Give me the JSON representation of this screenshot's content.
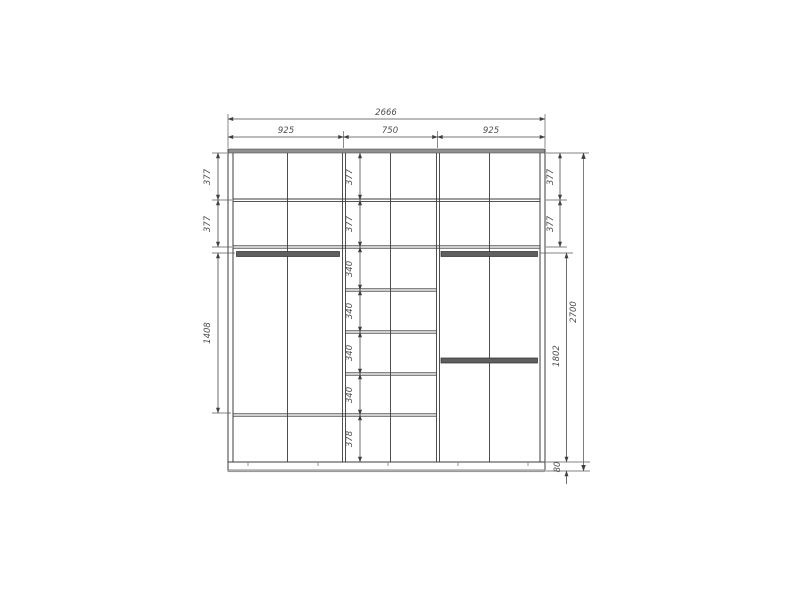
{
  "dimensions": {
    "overall_width": "2666",
    "top_sections": [
      "925",
      "750",
      "925"
    ],
    "left_column": [
      "377",
      "377",
      "1408"
    ],
    "center_column": [
      "377",
      "377",
      "340",
      "340",
      "340",
      "340",
      "378"
    ],
    "right_column": [
      "377",
      "377",
      "1802"
    ],
    "overall_height": "2700",
    "plinth_height": "80"
  },
  "colors": {
    "line": "#3c3c3c",
    "panel_gray": "#8f8f8f",
    "rod_gray": "#5f5f5f",
    "dim_line": "#4a4a4a",
    "dim_text": "#4f4f4f",
    "background": "#ffffff"
  }
}
